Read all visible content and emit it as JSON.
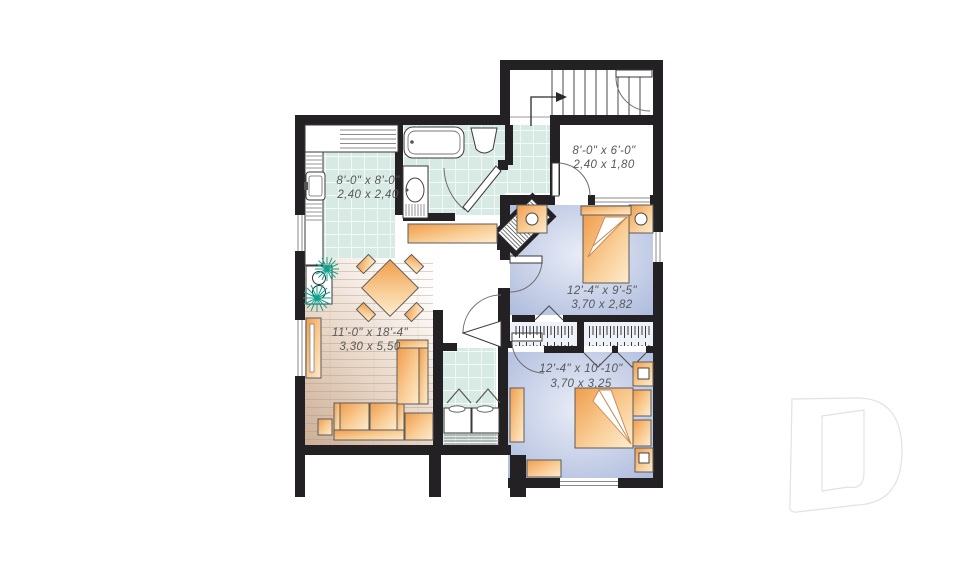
{
  "plan": {
    "name": "basement-apartment-floor-plan",
    "logo": "drummond-d-watermark",
    "colors": {
      "wall": "#242124",
      "tile": "#d7eae4",
      "tile_grid": "#ffffff",
      "bedroom_floor_edge": "#a8b7da",
      "bedroom_floor_center": "#eaedf7",
      "wood_dark": "#cbae97",
      "wood_light": "#fdfcfb",
      "furniture_dark": "#ef9440",
      "furniture_light": "#fdeacb",
      "plant": "#0fa18d",
      "label_text": "#57585a",
      "logo_line": "#e2e2e2"
    },
    "rooms": [
      {
        "id": "kitchen",
        "imperial": "8'-0\" x 8'-0\"",
        "metric": "2,40 x 2,40"
      },
      {
        "id": "entry",
        "imperial": "8'-0\" x 6'-0\"",
        "metric": "2,40 x 1,80"
      },
      {
        "id": "bedroom1",
        "imperial": "12'-4\" x 9'-5\"",
        "metric": "3,70 x 2,82"
      },
      {
        "id": "living",
        "imperial": "11'-0\" x 18'-4\"",
        "metric": "3,30 x 5,50"
      },
      {
        "id": "bedroom2",
        "imperial": "12'-4\" x 10'-10\"",
        "metric": "3,70 x 3,25"
      }
    ]
  }
}
